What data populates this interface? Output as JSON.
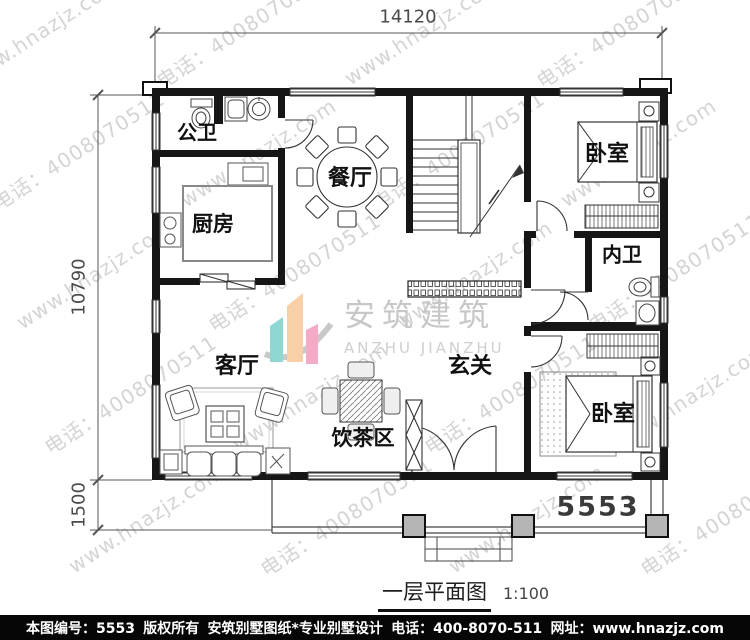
{
  "watermark": {
    "lines": [
      "www.hnazjz.com",
      "电话：4008070511"
    ],
    "color": "#d4d4d4"
  },
  "logo": {
    "cn": "安筑建筑",
    "en": "ANZHU JIANZHU",
    "bar_colors": {
      "teal": "#8ed7d2",
      "peach": "#f9cfa8",
      "pink": "#f3aac6",
      "swoosh": "#c9c9c9"
    }
  },
  "dims": {
    "width_total": "14120",
    "depth_main": "10790",
    "depth_porch": "1500"
  },
  "plan_no": "5553",
  "title": {
    "name": "一层平面图",
    "scale": "1:100"
  },
  "rooms": {
    "public_bath": "公卫",
    "kitchen": "厨房",
    "dining": "餐厅",
    "bedroom_top": "卧室",
    "inner_bath": "内卫",
    "living": "客厅",
    "tea_area": "饮茶区",
    "entry": "玄关",
    "bedroom_bottom": "卧室"
  },
  "footer": {
    "doc_number": "本图编号：5553",
    "copyright": "版权所有",
    "studio": "安筑别墅图纸*专业别墅设计",
    "phone": "电话：400-8070-511",
    "website": "网址：www.hnazjz.com"
  }
}
